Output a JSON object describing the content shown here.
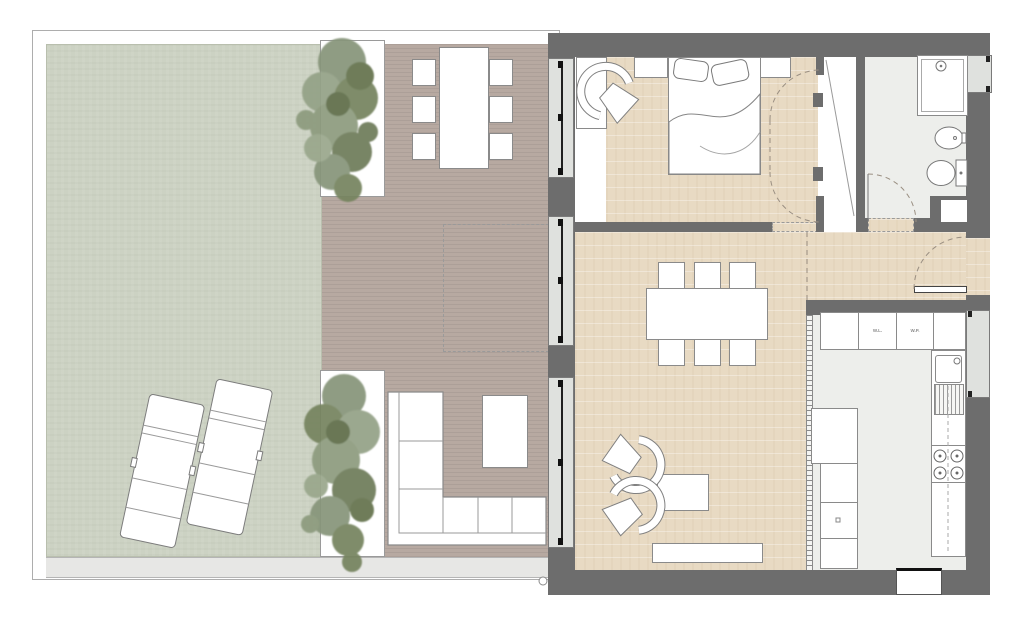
{
  "palette": {
    "wall": "#6d6d6d",
    "deck": "#b7a9a1",
    "lawn": "#ccd2c3",
    "wood_floor": "#e8dac3",
    "tile_floor": "#edeeeb",
    "glass": "#dfe1de",
    "walkway": "#e7e7e5",
    "furniture_line": "#8a8a8a",
    "frame_line": "#adadad",
    "page_bg": "#ffffff",
    "tree_green_light": "#9aa78c",
    "tree_green_mid": "#7d8b69",
    "tree_green_dark": "#5f6d4c"
  },
  "kitchen": {
    "cabinet_labels": [
      "W.L.",
      "W.P."
    ]
  },
  "plan": {
    "type": "apartment floor plan with garden and deck terrace",
    "outdoor_areas": [
      "lawn",
      "wood-deck-terrace",
      "walkway",
      "planter-with-tree-top",
      "planter-with-tree-bottom"
    ],
    "outdoor_furniture": [
      "outdoor-dining-table-6-chairs",
      "l-shaped-outdoor-sofa",
      "outdoor-side-table",
      "sun-lounger",
      "sun-lounger"
    ],
    "rooms": [
      "bedroom",
      "wardrobe-closet",
      "bathroom",
      "entrance-hall",
      "living-dining-room",
      "kitchen"
    ],
    "bedroom_furniture": [
      "double-bed",
      "nightstand-left",
      "nightstand-right",
      "armchair",
      "dresser"
    ],
    "bathroom_fixtures": [
      "shower",
      "bidet",
      "toilet"
    ],
    "living_furniture": [
      "dining-table-6-chairs",
      "sectional-sofa-with-chaise",
      "coffee-table",
      "armchair",
      "armchair",
      "tv-sideboard"
    ],
    "kitchen_fixtures": [
      "wall-cabinet-row",
      "sink",
      "drainer",
      "cooktop-4-burners",
      "tall-unit-column"
    ]
  }
}
